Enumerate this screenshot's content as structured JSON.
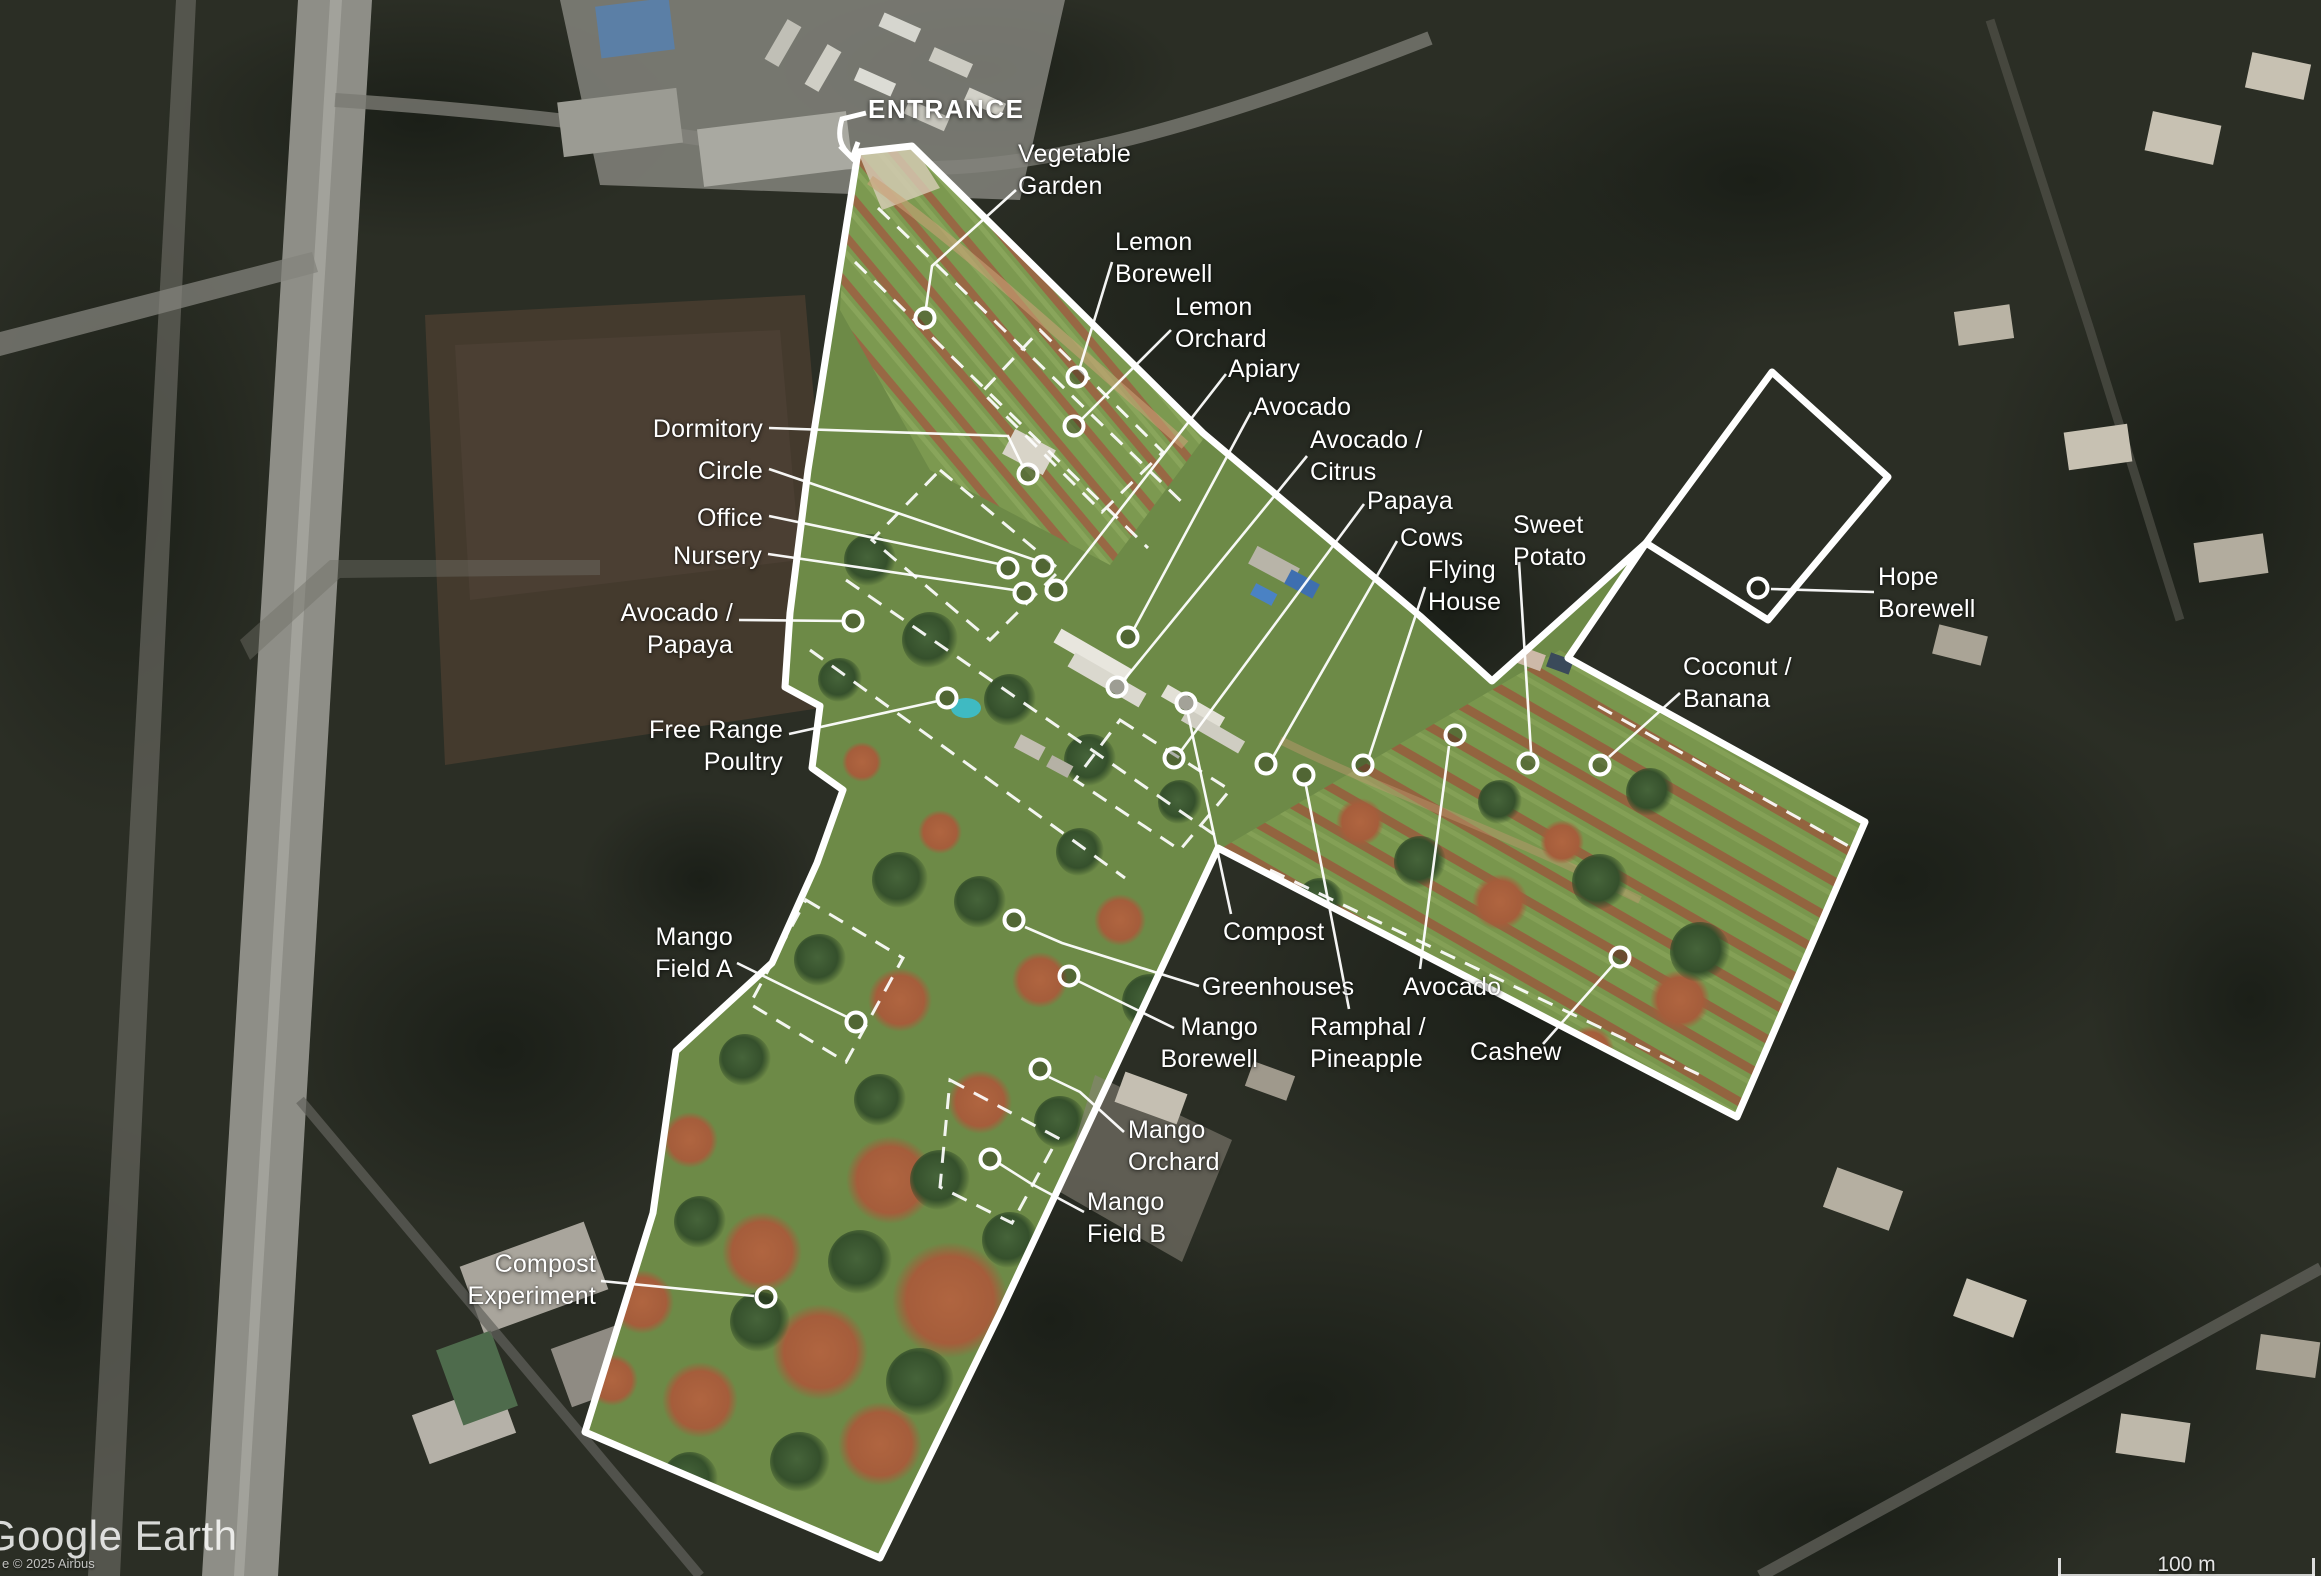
{
  "map": {
    "attribution": {
      "logo": "Google Earth",
      "copyright": "e © 2025 Airbus"
    },
    "scale_bar": {
      "label": "100 m"
    },
    "entrance": {
      "label": "ENTRANCE"
    },
    "boundary_color": "#ffffff",
    "features": [
      {
        "id": "vegetable-garden",
        "label": "Vegetable\nGarden",
        "align": "left",
        "x": 1018,
        "y": 138,
        "leader": [
          [
            1016,
            190
          ],
          [
            932,
            266
          ],
          [
            926,
            308
          ]
        ],
        "circle": [
          925,
          318
        ]
      },
      {
        "id": "lemon-borewell",
        "label": "Lemon\nBorewell",
        "align": "left",
        "x": 1115,
        "y": 226,
        "leader": [
          [
            1112,
            262
          ],
          [
            1080,
            367
          ]
        ],
        "circle": [
          1077,
          377
        ]
      },
      {
        "id": "lemon-orchard",
        "label": "Lemon\nOrchard",
        "align": "left",
        "x": 1175,
        "y": 291,
        "leader": [
          [
            1171,
            330
          ],
          [
            1082,
            419
          ]
        ],
        "circle": [
          1074,
          426
        ]
      },
      {
        "id": "apiary",
        "label": "Apiary",
        "align": "left",
        "x": 1228,
        "y": 353,
        "leader": [
          [
            1226,
            374
          ],
          [
            1063,
            583
          ]
        ],
        "circle": [
          1056,
          590
        ]
      },
      {
        "id": "avocado-north",
        "label": "Avocado",
        "align": "left",
        "x": 1253,
        "y": 391,
        "leader": [
          [
            1251,
            412
          ],
          [
            1134,
            629
          ]
        ],
        "circle": [
          1128,
          637
        ]
      },
      {
        "id": "avocado-citrus",
        "label": "Avocado /\nCitrus",
        "align": "left",
        "x": 1310,
        "y": 424,
        "leader": [
          [
            1307,
            456
          ],
          [
            1124,
            680
          ]
        ],
        "circle": [
          1117,
          687
        ]
      },
      {
        "id": "papaya",
        "label": "Papaya",
        "align": "left",
        "x": 1367,
        "y": 485,
        "leader": [
          [
            1364,
            504
          ],
          [
            1181,
            751
          ]
        ],
        "circle": [
          1174,
          758
        ]
      },
      {
        "id": "cows",
        "label": "Cows",
        "align": "left",
        "x": 1400,
        "y": 522,
        "leader": [
          [
            1397,
            541
          ],
          [
            1273,
            757
          ]
        ],
        "circle": [
          1266,
          764
        ]
      },
      {
        "id": "flying-house",
        "label": "Flying\nHouse",
        "align": "left",
        "x": 1428,
        "y": 554,
        "leader": [
          [
            1425,
            587
          ],
          [
            1369,
            757
          ]
        ],
        "circle": [
          1363,
          765
        ]
      },
      {
        "id": "sweet-potato",
        "label": "Sweet\nPotato",
        "align": "left",
        "x": 1513,
        "y": 509,
        "leader": [
          [
            1519,
            562
          ],
          [
            1531,
            752
          ]
        ],
        "circle": [
          1528,
          763
        ]
      },
      {
        "id": "hope-borewell",
        "label": "Hope\nBorewell",
        "align": "left",
        "x": 1878,
        "y": 561,
        "leader": [
          [
            1874,
            592
          ],
          [
            1771,
            589
          ]
        ],
        "circle": [
          1758,
          588
        ]
      },
      {
        "id": "coconut-banana",
        "label": "Coconut /\nBanana",
        "align": "left",
        "x": 1683,
        "y": 651,
        "leader": [
          [
            1680,
            693
          ],
          [
            1609,
            757
          ]
        ],
        "circle": [
          1600,
          765
        ]
      },
      {
        "id": "dormitory",
        "label": "Dormitory",
        "align": "right",
        "x": 763,
        "y": 413,
        "leader": [
          [
            769,
            428
          ],
          [
            1008,
            436
          ],
          [
            1022,
            465
          ]
        ],
        "circle": [
          1028,
          474
        ]
      },
      {
        "id": "circle",
        "label": "Circle",
        "align": "right",
        "x": 763,
        "y": 455,
        "leader": [
          [
            769,
            469
          ],
          [
            1035,
            560
          ]
        ],
        "circle": [
          1043,
          566
        ]
      },
      {
        "id": "office",
        "label": "Office",
        "align": "right",
        "x": 763,
        "y": 502,
        "leader": [
          [
            769,
            516
          ],
          [
            999,
            564
          ]
        ],
        "circle": [
          1008,
          568
        ]
      },
      {
        "id": "nursery",
        "label": "Nursery",
        "align": "right",
        "x": 762,
        "y": 540,
        "leader": [
          [
            768,
            554
          ],
          [
            1014,
            590
          ]
        ],
        "circle": [
          1024,
          593
        ]
      },
      {
        "id": "avocado-papaya",
        "label": "Avocado /\nPapaya",
        "align": "right",
        "x": 733,
        "y": 597,
        "leader": [
          [
            739,
            620
          ],
          [
            843,
            621
          ]
        ],
        "circle": [
          853,
          621
        ]
      },
      {
        "id": "free-range-poultry",
        "label": "Free Range\nPoultry",
        "align": "right",
        "x": 783,
        "y": 714,
        "leader": [
          [
            789,
            734
          ],
          [
            938,
            701
          ]
        ],
        "circle": [
          947,
          698
        ]
      },
      {
        "id": "mango-field-a",
        "label": "Mango\nField A",
        "align": "right",
        "x": 733,
        "y": 921,
        "leader": [
          [
            737,
            963
          ],
          [
            847,
            1017
          ]
        ],
        "circle": [
          856,
          1022
        ]
      },
      {
        "id": "compost",
        "label": "Compost",
        "align": "left",
        "x": 1223,
        "y": 916,
        "leader": [
          [
            1231,
            914
          ],
          [
            1188,
            714
          ]
        ],
        "circle": [
          1186,
          703
        ]
      },
      {
        "id": "greenhouses",
        "label": "Greenhouses",
        "align": "left",
        "x": 1202,
        "y": 971,
        "leader": [
          [
            1199,
            986
          ],
          [
            1062,
            943
          ],
          [
            1025,
            927
          ]
        ],
        "circle": [
          1014,
          920
        ]
      },
      {
        "id": "avocado-south",
        "label": "Avocado",
        "align": "left",
        "x": 1403,
        "y": 971,
        "leader": [
          [
            1420,
            969
          ],
          [
            1449,
            746
          ]
        ],
        "circle": [
          1455,
          735
        ]
      },
      {
        "id": "mango-borewell",
        "label": "Mango\nBorewell",
        "align": "right",
        "x": 1258,
        "y": 1011,
        "leader": [
          [
            1174,
            1028
          ],
          [
            1078,
            981
          ]
        ],
        "circle": [
          1069,
          976
        ]
      },
      {
        "id": "ramphal-pineapple",
        "label": "Ramphal /\nPineapple",
        "align": "left",
        "x": 1310,
        "y": 1011,
        "leader": [
          [
            1349,
            1009
          ],
          [
            1306,
            786
          ]
        ],
        "circle": [
          1304,
          775
        ]
      },
      {
        "id": "cashew",
        "label": "Cashew",
        "align": "left",
        "x": 1470,
        "y": 1036,
        "leader": [
          [
            1543,
            1044
          ],
          [
            1613,
            965
          ]
        ],
        "circle": [
          1620,
          957
        ]
      },
      {
        "id": "mango-orchard",
        "label": "Mango\nOrchard",
        "align": "left",
        "x": 1128,
        "y": 1114,
        "leader": [
          [
            1124,
            1132
          ],
          [
            1080,
            1092
          ],
          [
            1049,
            1077
          ]
        ],
        "circle": [
          1040,
          1069
        ]
      },
      {
        "id": "mango-field-b",
        "label": "Mango\nField B",
        "align": "left",
        "x": 1087,
        "y": 1186,
        "leader": [
          [
            1084,
            1212
          ],
          [
            1030,
            1183
          ],
          [
            1000,
            1164
          ]
        ],
        "circle": [
          990,
          1159
        ]
      },
      {
        "id": "compost-experiment",
        "label": "Compost\nExperiment",
        "align": "right",
        "x": 596,
        "y": 1248,
        "leader": [
          [
            601,
            1281
          ],
          [
            754,
            1296
          ]
        ],
        "circle": [
          766,
          1297
        ]
      }
    ]
  }
}
